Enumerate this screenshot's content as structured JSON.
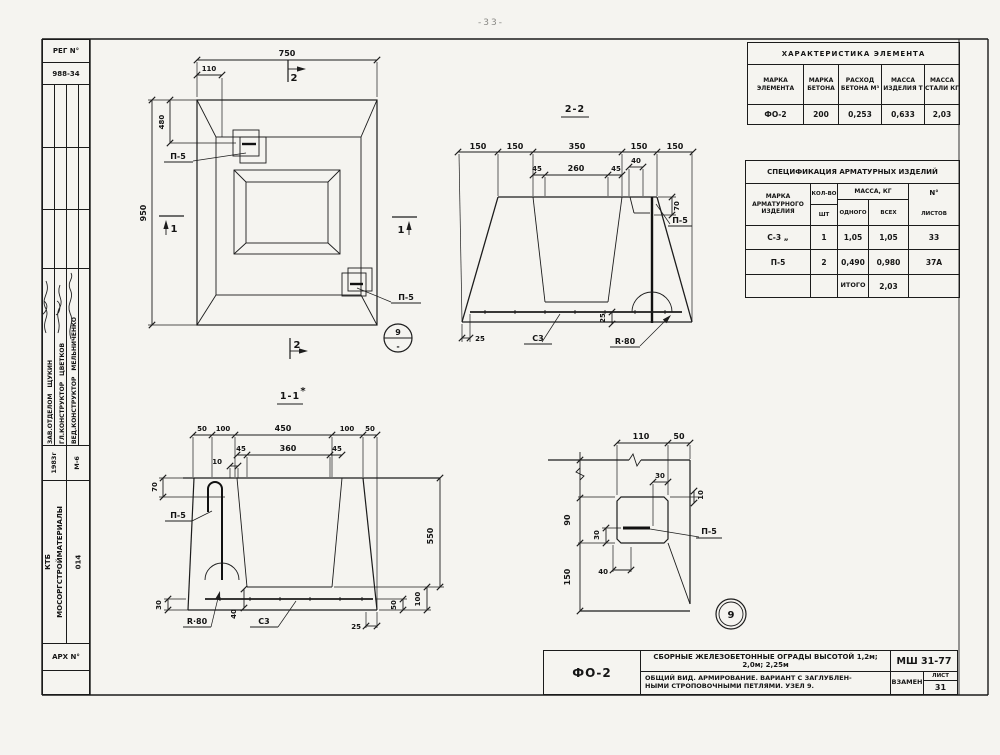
{
  "page": {
    "number": "-33-"
  },
  "stamp_left": {
    "reg_label": "РЕГ N°",
    "reg_number": "988-34",
    "signers": [
      {
        "role": "ЗАВ.ОТДЕЛОМ",
        "name": "ЩУКИН"
      },
      {
        "role": "ГЛ.КОНСТРУКТОР",
        "name": "ЦВЕТКОВ"
      },
      {
        "role": "ВЕД.КОНСТРУКТОР",
        "name": "МЕЛЬНИЧЕНКО"
      }
    ],
    "year": "1983г",
    "group": "М-6",
    "org_line1": "КТБ",
    "org_line2": "МОСОРГСТРОЙМАТЕРИАЛЫ",
    "org_number": "014",
    "arch_label": "АРХ N°"
  },
  "char_table": {
    "title": "ХАРАКТЕРИСТИКА  ЭЛЕМЕНТА",
    "headers": [
      "МАРКА ЭЛЕМЕНТА",
      "МАРКА БЕТОНА",
      "РАСХОД БЕТОНА М³",
      "МАССА ИЗДЕЛИЯ Т",
      "МАССА СТАЛИ КГ"
    ],
    "row": [
      "ФО-2",
      "200",
      "0,253",
      "0,633",
      "2,03"
    ]
  },
  "spec_table": {
    "title": "СПЕЦИФИКАЦИЯ АРМАТУРНЫХ ИЗДЕЛИЙ",
    "col_mark": "МАРКА АРМАТУРНОГО ИЗДЕЛИЯ",
    "col_qty_top": "КОЛ-ВО",
    "col_qty_bottom": "ШТ",
    "col_mass": "МАССА, КГ",
    "col_mass_one": "ОДНОГО",
    "col_mass_all": "ВСЕХ",
    "col_sheets_top": "N°",
    "col_sheets_bottom": "ЛИСТОВ",
    "rows": [
      [
        "С-3 „",
        "1",
        "1,05",
        "1,05",
        "33"
      ],
      [
        "П-5",
        "2",
        "0,490",
        "0,980",
        "37А"
      ]
    ],
    "total_label": "ИТОГО",
    "total_value": "2,03"
  },
  "title_block": {
    "mark": "ФО-2",
    "series": "СБОРНЫЕ ЖЕЛЕЗОБЕТОННЫЕ ОГРАДЫ ВЫСОТОЙ 1,2м; 2,0м; 2,25м",
    "desc_line1": "ОБЩИЙ ВИД. АРМИРОВАНИЕ. ВАРИАНТ С ЗАГЛУБЛЕН-",
    "desc_line2": "НЫМИ СТРОПОВОЧНЫМИ ПЕТЛЯМИ. УЗЕЛ 9.",
    "doc": "МШ 31-77",
    "replaced": "ВЗАМЕН",
    "sheet_label": "ЛИСТ",
    "sheet_number": "31"
  },
  "plan": {
    "dim_width": "750",
    "dim_loop_offset": "110",
    "dim_loop_depth": "480",
    "dim_height": "950",
    "loop_label_top": "П-5",
    "loop_label_bottom": "П-5",
    "cut_2": "2",
    "cut_1": "1",
    "detail_num": "9",
    "detail_sheet": "-",
    "note_mark": "*"
  },
  "s22": {
    "title": "2-2",
    "top": [
      "150",
      "150",
      "350",
      "150",
      "150"
    ],
    "mid": [
      "45",
      "260",
      "45"
    ],
    "loop_w": "40",
    "pocket_d": "70",
    "edge": "25",
    "cover": "25",
    "mesh": "С3",
    "radius": "R·80",
    "loop": "П-5"
  },
  "s11": {
    "title": "1-1",
    "top": [
      "50",
      "100",
      "450",
      "100",
      "50"
    ],
    "mid": [
      "45",
      "360",
      "45"
    ],
    "bar": "10",
    "pocket_d": "70",
    "loop": "П-5",
    "left_b": "30",
    "radius": "R·80",
    "d40": "40",
    "mesh": "С3",
    "d25": "25",
    "height": "550",
    "d100": "100",
    "d50": "50"
  },
  "d9": {
    "w": "110",
    "e": "50",
    "t30": "30",
    "t10": "10",
    "d90": "90",
    "d150": "150",
    "i30": "30",
    "i40": "40",
    "loop": "П-5",
    "num": "9"
  }
}
